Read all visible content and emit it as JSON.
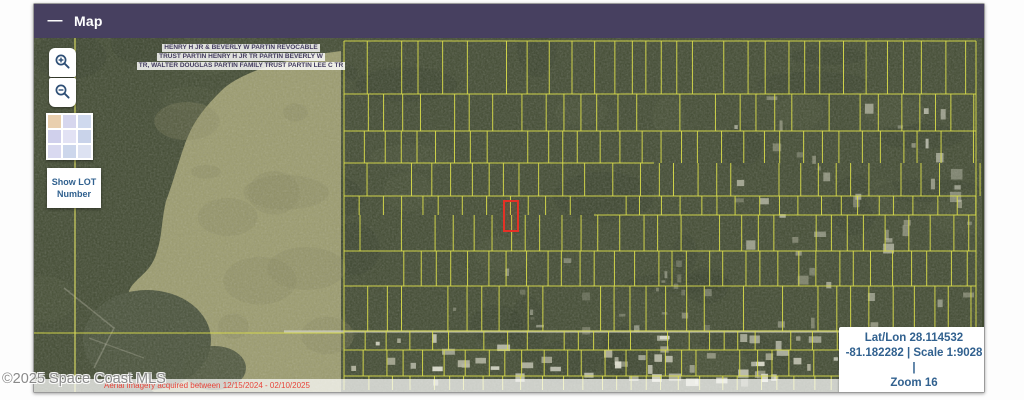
{
  "window": {
    "title": "Map",
    "minimize_glyph": "—"
  },
  "map": {
    "owner_label": {
      "lines": [
        "HENRY H JR & BEVERLY W PARTIN REVOCABLE",
        "TRUST PARTIN HENRY H JR TR PARTIN BEVERLY W",
        "TR, WALTER DOUGLAS PARTIN FAMILY TRUST PARTIN LEE C TR"
      ]
    },
    "controls": {
      "zoom_in_icon": "magnifier-plus",
      "zoom_out_icon": "magnifier-minus",
      "basemap_toggle_icon": "basemap-thumbnail",
      "show_lot_label": "Show LOT Number"
    },
    "info_box": {
      "lines": [
        "Lat/Lon 28.114532",
        "-81.182282 | Scale 1:9028 |",
        "Zoom 16"
      ]
    },
    "attribution": {
      "imagery_note": "Aerial imagery acquired between 12/15/2024 - 02/10/2025",
      "powered_by": "Powered by Esri"
    },
    "watermark": "©2025 Space Coast MLS"
  },
  "colors": {
    "header_bg": "#474060",
    "forest": "#414a31",
    "forest_dark": "#2e3524",
    "forest_light": "#5a6240",
    "marsh": "#9b9b6d",
    "marsh_dark": "#86865c",
    "island": "#49523a",
    "parcel_line": "#d9dc4a",
    "road_light": "#cfcfc0",
    "highlight_red": "#e53126",
    "control_icon": "#2e4f76",
    "info_text": "#31618f"
  }
}
